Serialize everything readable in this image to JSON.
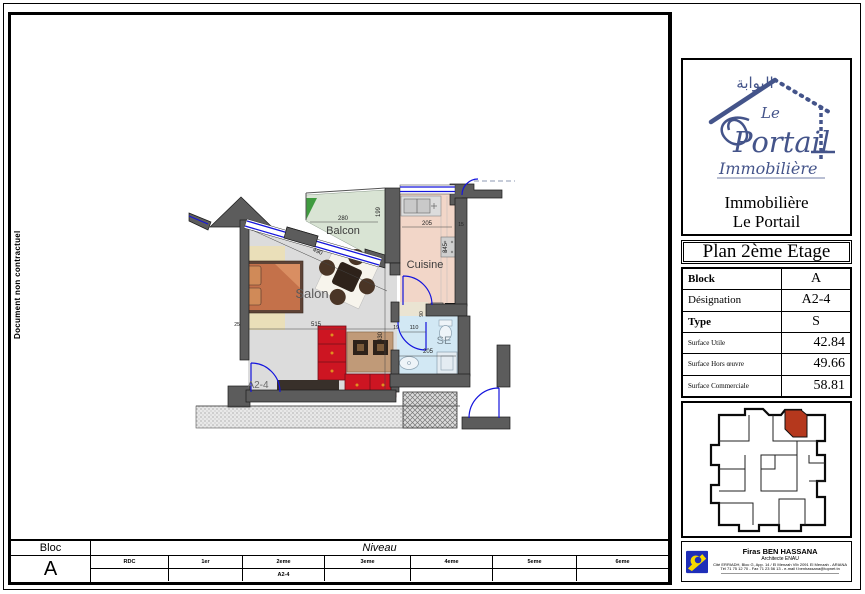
{
  "page": {
    "side_note": "Document non contractuel"
  },
  "logo": {
    "arabic": "البوابة",
    "script_le": "Le",
    "script_portail": "Portail",
    "script_immobiliere": "Immobilière",
    "firm_line1": "Immobilière",
    "firm_line2": "Le Portail"
  },
  "panel": {
    "title": "Plan 2ème Etage",
    "info": {
      "rows": [
        {
          "label": "Block",
          "value": "A"
        },
        {
          "label": "Désignation",
          "value": "A2-4"
        },
        {
          "label": "Type",
          "value": "S"
        },
        {
          "label": "Surface Utile",
          "value": "42.84"
        },
        {
          "label": "Surface Hors œuvre",
          "value": "49.66"
        },
        {
          "label": "Surface Commerciale",
          "value": "58.81"
        }
      ]
    }
  },
  "plan": {
    "rooms": {
      "balcon": "Balcon",
      "cuisine": "Cuisine",
      "salon": "Salon",
      "se": "SE",
      "unit": "A2-4"
    },
    "dims": {
      "balcon_w": "280",
      "balcon_d": "199",
      "cuisine_w": "205",
      "cuisine_d": "345",
      "cuisine_s": "15",
      "salon_diag": "490",
      "salon_w": "515",
      "salon_s": "25",
      "salon_d": "430",
      "hall_a": "19",
      "hall_b": "110",
      "hall_c": "90",
      "se_w": "205"
    }
  },
  "niveau": {
    "bloc_label": "Bloc",
    "bloc_value": "A",
    "label": "Niveau",
    "columns": [
      "RDC",
      "1er",
      "2eme",
      "3eme",
      "4eme",
      "5eme",
      "6eme"
    ],
    "unit_value": "A2-4",
    "unit_column": "2eme"
  },
  "contact": {
    "name": "Firas BEN HASSANA",
    "role": "Architecte ENAU",
    "address": "Cité ERRIADH, Bloc G, App. 14 / El Menzah VIb 2091 El Menzah - ARIANA",
    "phone": "Tél 71 75 12 70 - Fax 71 23 56 13 - e-mail f.benhassana@topnet.tn"
  },
  "colors": {
    "accent_blue": "#44548a",
    "window_blue": "#1414dd",
    "wall_gray": "#5c5c5c",
    "balcon_green": "#d9e4d4",
    "cuisine_pink": "#f2d6c8",
    "se_blue": "#d2e8f4",
    "salon_gray": "#dcdcdc",
    "highlight_red": "#b5381d",
    "sofa_red": "#cd1522",
    "logo_blue": "#1e2eb8",
    "logo_yellow": "#f5d800"
  }
}
